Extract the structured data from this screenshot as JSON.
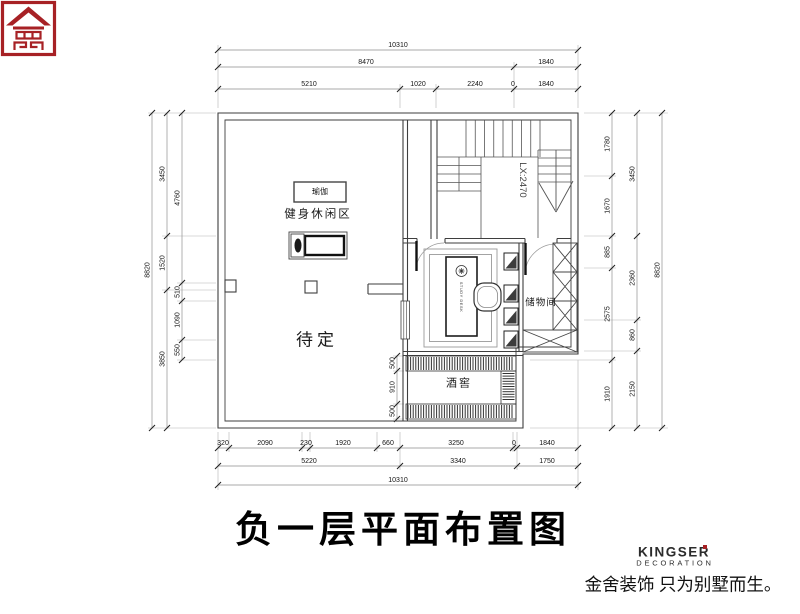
{
  "title": "负一层平面布置图",
  "plan": {
    "labels": {
      "yoga": "瑜伽",
      "fitness_zone": "健身休闲区",
      "pending": "待定",
      "wine_cellar": "酒窖",
      "storage": "储物间",
      "stair_note": "LX:2470",
      "desk": "STUDY DESK"
    }
  },
  "dims": {
    "top": {
      "row1": [
        "10310"
      ],
      "row2": [
        "8470",
        "1840"
      ],
      "row3": [
        "5210",
        "1020",
        "2240",
        "0",
        "1840"
      ]
    },
    "bottom": {
      "row1": [
        "320",
        "2090",
        "230",
        "1920",
        "660",
        "3250",
        "0",
        "1840"
      ],
      "row2": [
        "5220",
        "3340",
        "1750"
      ],
      "row3": [
        "10310"
      ]
    },
    "left": {
      "outer": "8820",
      "mid": [
        "3450",
        "1520",
        "3850"
      ],
      "inner": [
        "4760",
        "510",
        "1090",
        "550"
      ]
    },
    "right": {
      "inner": [
        "1780",
        "1670",
        "885",
        "2575",
        "1910"
      ],
      "mid": [
        "3450",
        "2360",
        "860",
        "2150"
      ],
      "outer": "8820"
    },
    "cellar": [
      "500",
      "910",
      "500"
    ]
  },
  "logo": {
    "brand": "KINGSER",
    "division": "DECORATION",
    "tagline": "金舍装饰 只为别墅而生。",
    "accent_color": "#a72125"
  }
}
